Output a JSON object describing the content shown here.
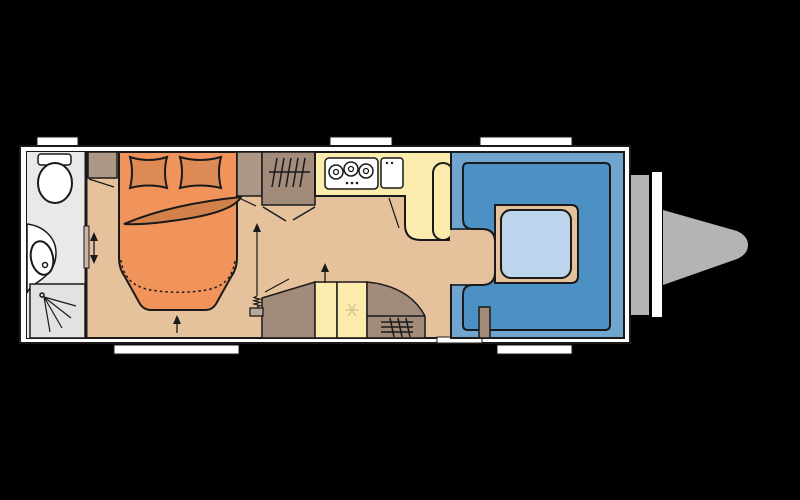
{
  "title": "Caravan floor plan (top view)",
  "colors": {
    "background": "#000000",
    "outline": "#1a1a1a",
    "wall": "#ffffff",
    "window": "#ffffff",
    "floor": "#e5c29c",
    "bathroom_floor": "#e9e9e9",
    "shower_tray": "#e2e2e2",
    "fixture": "#ffffff",
    "bed": "#f0945c",
    "pillow": "#dd8a55",
    "blanket": "#d2814b",
    "cabinet_light": "#ad9786",
    "cabinet": "#a28b7a",
    "kitchen": "#fbecae",
    "seat_base": "#6fa5ce",
    "seat_cushion": "#4c90c4",
    "table": "#bcd5ec",
    "drawbar": "#b4b4b4",
    "snowflake": "#d8c994",
    "door_slide": "#c9b6a4",
    "door_tab": "#b9a897"
  },
  "counts": {
    "hob_burners": 3,
    "top_windows": 3,
    "bottom_windows": 2,
    "shower_spray_lines": 4,
    "wardrobe_hangers": 5
  },
  "features": {
    "washroom": [
      "toilet",
      "washbasin",
      "shower"
    ],
    "bedroom": [
      "island-bed",
      "pillows",
      "wardrobe",
      "sliding-door"
    ],
    "kitchen": [
      "three-burner-hob",
      "sink",
      "fridge",
      "heater"
    ],
    "lounge": [
      "u-shaped-dinette",
      "table"
    ],
    "exterior": [
      "drawbar-hitch",
      "entry-door",
      "windows"
    ]
  }
}
